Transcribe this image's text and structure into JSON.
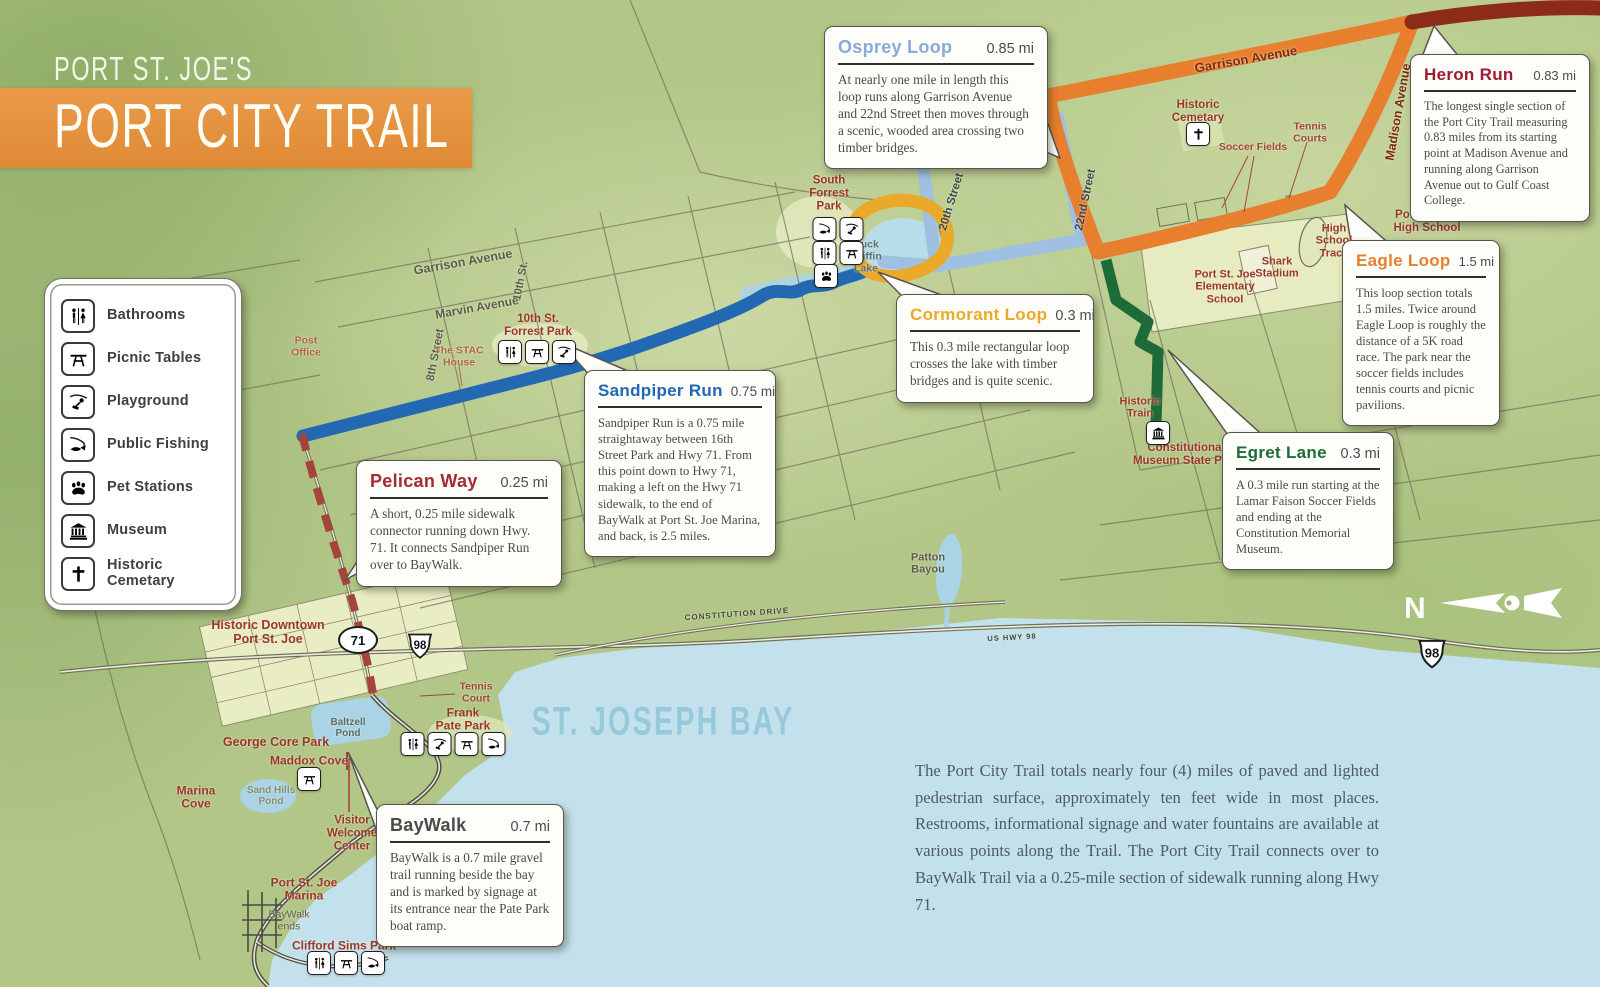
{
  "title": {
    "kicker": "PORT ST. JOE'S",
    "main": "PORT CITY TRAIL"
  },
  "legend": {
    "items": [
      {
        "icon": "restroom-icon",
        "label": "Bathrooms"
      },
      {
        "icon": "picnic-table-icon",
        "label": "Picnic Tables"
      },
      {
        "icon": "playground-icon",
        "label": "Playground"
      },
      {
        "icon": "fishing-icon",
        "label": "Public Fishing"
      },
      {
        "icon": "paw-icon",
        "label": "Pet Stations"
      },
      {
        "icon": "museum-icon",
        "label": "Museum"
      },
      {
        "icon": "cross-icon",
        "label": "Historic\nCemetary"
      }
    ]
  },
  "callouts": [
    {
      "id": "osprey",
      "name": "Osprey Loop",
      "distance": "0.85 mi",
      "color": "#89a9d9",
      "body": "At nearly one mile in length this loop runs along Garrison Avenue and 22nd Street then moves through a scenic, wooded area crossing two timber bridges."
    },
    {
      "id": "heron",
      "name": "Heron Run",
      "distance": "0.83 mi",
      "color": "#9e1b32",
      "body": "The longest single section of the Port City Trail measuring 0.83 miles from its starting point at Madison Avenue and running along Garrison Avenue out to Gulf Coast College."
    },
    {
      "id": "eagle",
      "name": "Eagle Loop",
      "distance": "1.5 mi",
      "color": "#e87f2e",
      "body": "This loop section totals 1.5 miles. Twice around Eagle Loop is roughly the distance of a 5K road race. The park near the soccer fields includes tennis courts and picnic pavilions."
    },
    {
      "id": "cormorant",
      "name": "Cormorant Loop",
      "distance": "0.3 mi",
      "color": "#eaa928",
      "body": "This 0.3 mile rectangular loop crosses the lake with timber bridges and is quite scenic."
    },
    {
      "id": "sandpiper",
      "name": "Sandpiper Run",
      "distance": "0.75 mi",
      "color": "#2268b2",
      "body": "Sandpiper Run is a 0.75 mile straightaway between 16th Street Park and Hwy 71. From this point down to Hwy 71, making a left on the Hwy 71 sidewalk, to the end of BayWalk at Port St. Joe Marina, and back, is 2.5 miles."
    },
    {
      "id": "egret",
      "name": "Egret Lane",
      "distance": "0.3 mi",
      "color": "#1d6b38",
      "body": "A 0.3 mile run starting at the Lamar Faison Soccer Fields and ending at the Constitution Memorial Museum."
    },
    {
      "id": "pelican",
      "name": "Pelican Way",
      "distance": "0.25 mi",
      "color": "#a32b35",
      "body": "A short, 0.25 mile sidewalk connector running down Hwy. 71. It connects Sandpiper Run over to BayWalk."
    },
    {
      "id": "baywalk",
      "name": "BayWalk",
      "distance": "0.7 mi",
      "color": "#4a4a4a",
      "body": "BayWalk is a 0.7 mile gravel trail running beside the bay and is marked by signage at its entrance near the Pate Park boat ramp."
    }
  ],
  "map_labels": {
    "garrison_avenue_w": "Garrison Avenue",
    "marvin_avenue": "Marvin Avenue",
    "eighth_street": "8th Street",
    "tenth_st": "10th St.",
    "post_office": "Post\nOffice",
    "stac_house": "The STAC\nHouse",
    "tenth_st_forrest_park": "10th St.\nForrest Park",
    "south_forrest_park": "South\nForrest\nPark",
    "buck_griffin_lake": "Buck\nGriffin\nLake",
    "twentieth_street": "20th Street",
    "twenty_second_street": "22nd Street",
    "garrison_avenue_e": "Garrison Avenue",
    "madison_avenue": "Madison Avenue",
    "historic_cemetary": "Historic\nCemetary",
    "soccer_fields": "Soccer Fields",
    "tennis_courts": "Tennis\nCourts",
    "port_st_joe_high_school": "Port St. Joe\nHigh School",
    "high_school_track": "High\nSchool\nTrack",
    "shark_stadium": "Shark\nStadium",
    "elementary_school": "Port St. Joe\nElementary\nSchool",
    "historic_train": "Historic\nTrain",
    "constitutional_museum": "Constitutional\nMuseum State Park",
    "patton_bayou": "Patton\nBayou",
    "constitution_drive": "CONSTITUTION DRIVE",
    "st_joseph_bay": "ST. JOSEPH BAY",
    "historic_downtown": "Historic Downtown\nPort St. Joe",
    "george_core_park": "George Core Park",
    "maddox_cove": "Maddox Cove",
    "marina_cove": "Marina\nCove",
    "sand_hills_pond": "Sand Hills\nPond",
    "baltzell_pond": "Baltzell\nPond",
    "visitor_welcome_center": "Visitor\nWelcome\nCenter",
    "port_st_joe_marina": "Port St. Joe\nMarina",
    "baywalk_ends": "BayWalk\nends",
    "clifford_sims_park": "Clifford Sims Park",
    "frank_pate_park": "Frank\nPate Park",
    "tennis_court": "Tennis\nCourt",
    "us_hwy_98": "US HWY 98"
  },
  "badges": {
    "hwy71": "71",
    "hwy98": "98"
  },
  "compass": {
    "north": "N"
  },
  "footer": {
    "text": "The Port City Trail totals nearly four (4) miles of paved and lighted pedestrian surface, approximately ten feet wide in most places. Restrooms, informational signage and water fountains are available at various points along the Trail. The Port City Trail connects over to BayWalk Trail via a 0.25-mile section of sidewalk running along Hwy 71."
  },
  "trail_colors": {
    "sandpiper": "#2268b2",
    "osprey": "#9fc0e0",
    "eagle_heron": "#e87f2e",
    "heron_dark": "#8c2b18",
    "cormorant": "#eaa928",
    "egret": "#1d6b38",
    "pelican": "#a5443a"
  },
  "water_color": "#c3e1ed"
}
